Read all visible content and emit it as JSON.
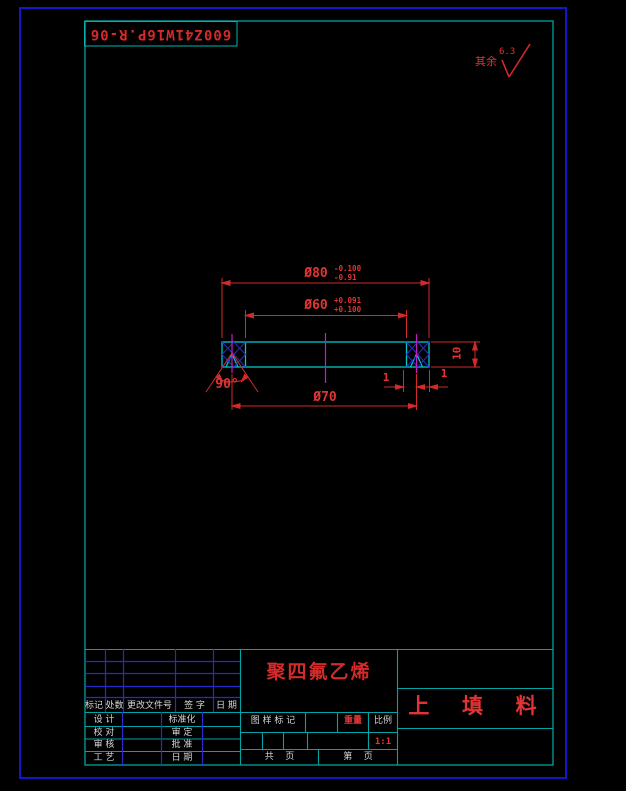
{
  "frame": {
    "part_number": "600Z41W16P.R-06",
    "surface_prefix": "其余",
    "surface_value": "6.3"
  },
  "dims": {
    "d80": "Ø80",
    "d80_tol_u": "-0.100",
    "d80_tol_l": "-0.91",
    "d60": "Ø60",
    "d60_tol_u": "+0.091",
    "d60_tol_l": "+0.100",
    "d70": "Ø70",
    "angle": "90°",
    "height": "10",
    "notch_left": "1",
    "notch_right": "1"
  },
  "title_block": {
    "rev_headers": [
      "标记",
      "处数",
      "更改文件号",
      "签 字",
      "日 期"
    ],
    "sign_left": [
      "设 计",
      "校 对",
      "审 核",
      "工 艺"
    ],
    "sign_right": [
      "标准化",
      "审 定",
      "批 准",
      "日 期"
    ],
    "material": "聚四氟乙烯",
    "part_name": "上  填  料",
    "stamp": "图 样 标 记",
    "weight": "重量",
    "scale": "比例",
    "scale_value": "1:1",
    "pages_total": "共    页",
    "page_no": "第    页"
  },
  "colors": {
    "outer_border": "#1616c8",
    "inner_frame": "#00a4a4",
    "table_blue": "#2a2acc",
    "dimension_red": "#d42a2a",
    "centerline_magenta": "#c31ec3",
    "hatch_blue": "#2a2ad4",
    "object_cyan": "#00c8c8",
    "text_white": "#d6d6d6"
  }
}
